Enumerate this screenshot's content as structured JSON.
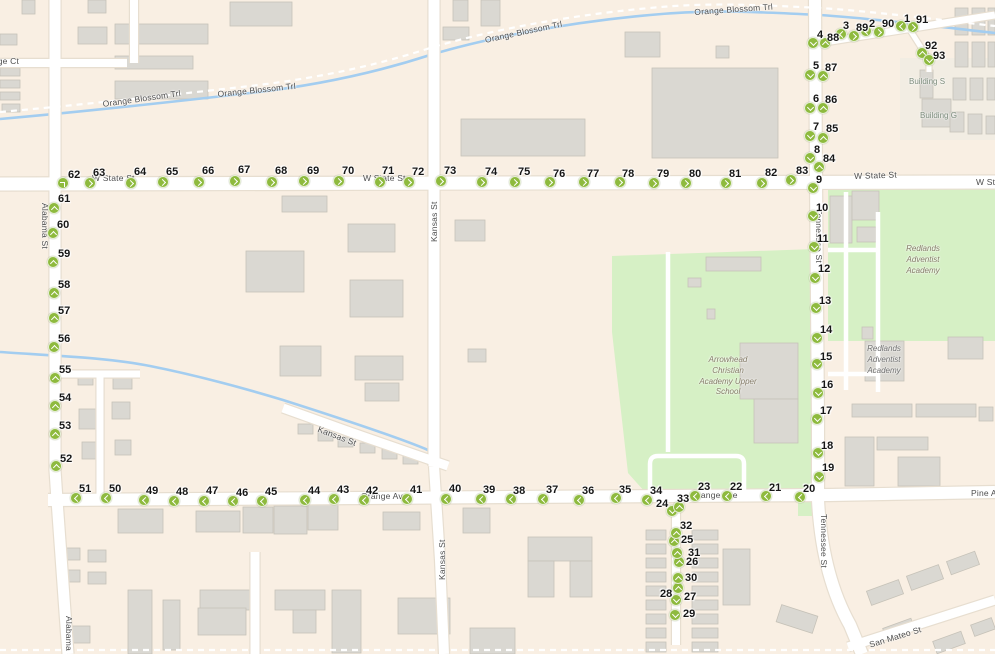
{
  "map": {
    "colors": {
      "background": "#f9efe3",
      "park": "#d6f0c5",
      "water": "#a3cdf0",
      "road": "#ffffff",
      "road_casing": "#e7ded0",
      "building": "#dad8d2",
      "building_outline": "#c6c2b8",
      "marker": "#8eba3e",
      "marker_arrow": "#ffffff",
      "street_label": "#4e4e4e",
      "poi_label": "#7d8d7d",
      "school_label": "#857c68"
    },
    "street_labels": [
      {
        "text": "Orange Ct",
        "x": -22,
        "y": 56,
        "rot": 0
      },
      {
        "text": "Orange Blossom Trl",
        "x": 102,
        "y": 99,
        "rot": -8
      },
      {
        "text": "Orange Blossom Trl",
        "x": 217,
        "y": 89,
        "rot": -6
      },
      {
        "text": "Orange Blossom Trl",
        "x": 484,
        "y": 35,
        "rot": -12
      },
      {
        "text": "Orange Blossom Trl",
        "x": 694,
        "y": 7,
        "rot": -4
      },
      {
        "text": "W State St",
        "x": 92,
        "y": 173,
        "rot": 0
      },
      {
        "text": "W State St",
        "x": 363,
        "y": 173,
        "rot": 0
      },
      {
        "text": "W State St",
        "x": 854,
        "y": 171,
        "rot": -2
      },
      {
        "text": "W State St",
        "x": 976,
        "y": 177,
        "rot": 0
      },
      {
        "text": "Alabama St",
        "x": 50,
        "y": 203,
        "rot": 90
      },
      {
        "text": "Alabama St",
        "x": 74,
        "y": 616,
        "rot": 90
      },
      {
        "text": "Kansas St",
        "x": 429,
        "y": 242,
        "rot": -90
      },
      {
        "text": "Kansas St",
        "x": 437,
        "y": 580,
        "rot": -90
      },
      {
        "text": "Kansas St",
        "x": 320,
        "y": 424,
        "rot": 21
      },
      {
        "text": "Tennessee St",
        "x": 824,
        "y": 209,
        "rot": 90
      },
      {
        "text": "Tennessee St",
        "x": 829,
        "y": 514,
        "rot": 90
      },
      {
        "text": "Orange Ave",
        "x": 361,
        "y": 491,
        "rot": 0
      },
      {
        "text": "Orange Ave",
        "x": 691,
        "y": 490,
        "rot": 0
      },
      {
        "text": "Pine Ave",
        "x": 971,
        "y": 488,
        "rot": 0
      },
      {
        "text": "San Mateo St",
        "x": 868,
        "y": 640,
        "rot": -17
      }
    ],
    "poi_labels": [
      {
        "lines": [
          "Building S"
        ],
        "x": 909,
        "y": 77,
        "w": 60,
        "center": false,
        "italic": false,
        "color": "#7d8d7d"
      },
      {
        "lines": [
          "Building G"
        ],
        "x": 920,
        "y": 111,
        "w": 60,
        "center": false,
        "italic": false,
        "color": "#7d8d7d"
      },
      {
        "lines": [
          "Redlands",
          "Adventist",
          "Academy"
        ],
        "x": 888,
        "y": 244,
        "w": 70,
        "center": true,
        "italic": true,
        "color": "#857c68"
      },
      {
        "lines": [
          "Redlands",
          "Adventist",
          "Academy"
        ],
        "x": 858,
        "y": 344,
        "w": 52,
        "center": true,
        "italic": true,
        "color": "#6f6f6f"
      },
      {
        "lines": [
          "Arrowhead",
          "Christian",
          "Academy Upper",
          "School"
        ],
        "x": 688,
        "y": 355,
        "w": 80,
        "center": true,
        "italic": true,
        "color": "#857c68"
      }
    ],
    "markers": [
      [
        1,
        901,
        26,
        "left",
        904,
        14
      ],
      [
        2,
        866,
        31,
        "left",
        869,
        19
      ],
      [
        3,
        841,
        34,
        "left",
        843,
        21
      ],
      [
        4,
        813,
        43,
        "down",
        817,
        30
      ],
      [
        5,
        810,
        75,
        "down",
        813,
        61
      ],
      [
        6,
        810,
        108,
        "down",
        813,
        94
      ],
      [
        7,
        810,
        136,
        "down",
        813,
        122
      ],
      [
        8,
        810,
        158,
        "down",
        814,
        145
      ],
      [
        9,
        813,
        188,
        "down",
        816,
        175
      ],
      [
        10,
        813,
        216,
        "down",
        816,
        203
      ],
      [
        11,
        814,
        247,
        "down",
        817,
        234
      ],
      [
        12,
        815,
        278,
        "down",
        818,
        264
      ],
      [
        13,
        816,
        308,
        "down",
        819,
        296
      ],
      [
        14,
        817,
        338,
        "down",
        820,
        325
      ],
      [
        15,
        817,
        364,
        "down",
        820,
        352
      ],
      [
        16,
        818,
        393,
        "down",
        821,
        380
      ],
      [
        17,
        817,
        419,
        "down",
        820,
        406
      ],
      [
        18,
        818,
        453,
        "down",
        821,
        441
      ],
      [
        19,
        819,
        477,
        "down",
        822,
        463
      ],
      [
        20,
        800,
        497,
        "left",
        803,
        484
      ],
      [
        21,
        766,
        496,
        "left",
        769,
        483
      ],
      [
        22,
        727,
        496,
        "left",
        730,
        482
      ],
      [
        23,
        695,
        496,
        "left",
        698,
        482
      ],
      [
        24,
        672,
        511,
        "down",
        656,
        499
      ],
      [
        25,
        674,
        541,
        "up",
        681,
        535
      ],
      [
        26,
        679,
        562,
        "up",
        686,
        557
      ],
      [
        27,
        676,
        600,
        "down",
        684,
        592
      ],
      [
        28,
        678,
        588,
        "up",
        660,
        589
      ],
      [
        29,
        675,
        615,
        "down",
        683,
        609
      ],
      [
        30,
        678,
        578,
        "up",
        685,
        573
      ],
      [
        31,
        677,
        553,
        "up",
        688,
        548
      ],
      [
        32,
        676,
        533,
        "up",
        680,
        521
      ],
      [
        33,
        679,
        507,
        "up",
        677,
        494
      ],
      [
        34,
        647,
        500,
        "left",
        650,
        486
      ],
      [
        35,
        616,
        498,
        "left",
        619,
        485
      ],
      [
        36,
        579,
        500,
        "left",
        582,
        486
      ],
      [
        37,
        543,
        499,
        "left",
        546,
        485
      ],
      [
        38,
        511,
        499,
        "left",
        513,
        486
      ],
      [
        39,
        481,
        499,
        "left",
        483,
        485
      ],
      [
        40,
        446,
        499,
        "left",
        449,
        484
      ],
      [
        41,
        407,
        499,
        "left",
        410,
        485
      ],
      [
        42,
        364,
        500,
        "left",
        366,
        486
      ],
      [
        43,
        334,
        499,
        "left",
        337,
        485
      ],
      [
        44,
        305,
        500,
        "left",
        308,
        486
      ],
      [
        45,
        262,
        501,
        "left",
        265,
        487
      ],
      [
        46,
        233,
        501,
        "left",
        236,
        488
      ],
      [
        47,
        204,
        501,
        "left",
        206,
        486
      ],
      [
        48,
        174,
        501,
        "left",
        176,
        487
      ],
      [
        49,
        144,
        500,
        "left",
        146,
        486
      ],
      [
        50,
        106,
        498,
        "left",
        109,
        484
      ],
      [
        51,
        76,
        498,
        "left",
        79,
        484
      ],
      [
        52,
        56,
        466,
        "up",
        60,
        454
      ],
      [
        53,
        55,
        434,
        "up",
        59,
        421
      ],
      [
        54,
        55,
        406,
        "up",
        59,
        393
      ],
      [
        55,
        55,
        378,
        "up",
        59,
        365
      ],
      [
        56,
        54,
        347,
        "up",
        58,
        334
      ],
      [
        57,
        54,
        318,
        "up",
        58,
        306
      ],
      [
        58,
        54,
        293,
        "up",
        58,
        280
      ],
      [
        59,
        53,
        262,
        "up",
        58,
        249
      ],
      [
        60,
        53,
        233,
        "up",
        57,
        220
      ],
      [
        61,
        54,
        208,
        "up",
        58,
        194
      ],
      [
        62,
        63,
        183,
        "upright",
        68,
        170
      ],
      [
        63,
        90,
        183,
        "right",
        93,
        168
      ],
      [
        64,
        131,
        183,
        "right",
        134,
        167
      ],
      [
        65,
        163,
        182,
        "right",
        166,
        167
      ],
      [
        66,
        199,
        182,
        "right",
        202,
        166
      ],
      [
        67,
        235,
        181,
        "right",
        238,
        165
      ],
      [
        68,
        272,
        182,
        "right",
        275,
        166
      ],
      [
        69,
        304,
        181,
        "right",
        307,
        166
      ],
      [
        70,
        339,
        181,
        "right",
        342,
        166
      ],
      [
        71,
        380,
        182,
        "right",
        382,
        166
      ],
      [
        72,
        409,
        182,
        "right",
        412,
        167
      ],
      [
        73,
        441,
        181,
        "right",
        444,
        166
      ],
      [
        74,
        482,
        182,
        "right",
        485,
        167
      ],
      [
        75,
        515,
        182,
        "right",
        518,
        167
      ],
      [
        76,
        550,
        182,
        "right",
        553,
        169
      ],
      [
        77,
        584,
        182,
        "right",
        587,
        169
      ],
      [
        78,
        620,
        182,
        "right",
        622,
        169
      ],
      [
        79,
        654,
        183,
        "right",
        657,
        169
      ],
      [
        80,
        686,
        183,
        "right",
        689,
        169
      ],
      [
        81,
        726,
        183,
        "right",
        729,
        169
      ],
      [
        82,
        762,
        183,
        "right",
        765,
        168
      ],
      [
        83,
        791,
        180,
        "right",
        796,
        166
      ],
      [
        84,
        819,
        167,
        "up",
        823,
        154
      ],
      [
        85,
        823,
        138,
        "up",
        826,
        124
      ],
      [
        86,
        823,
        108,
        "up",
        825,
        95
      ],
      [
        87,
        823,
        76,
        "up",
        825,
        63
      ],
      [
        88,
        825,
        43,
        "up",
        827,
        33
      ],
      [
        89,
        854,
        36,
        "right",
        856,
        23
      ],
      [
        90,
        879,
        32,
        "right",
        882,
        19
      ],
      [
        91,
        913,
        27,
        "right",
        916,
        15
      ],
      [
        92,
        922,
        53,
        "up",
        925,
        41
      ],
      [
        93,
        929,
        60,
        "down",
        933,
        51
      ]
    ]
  }
}
